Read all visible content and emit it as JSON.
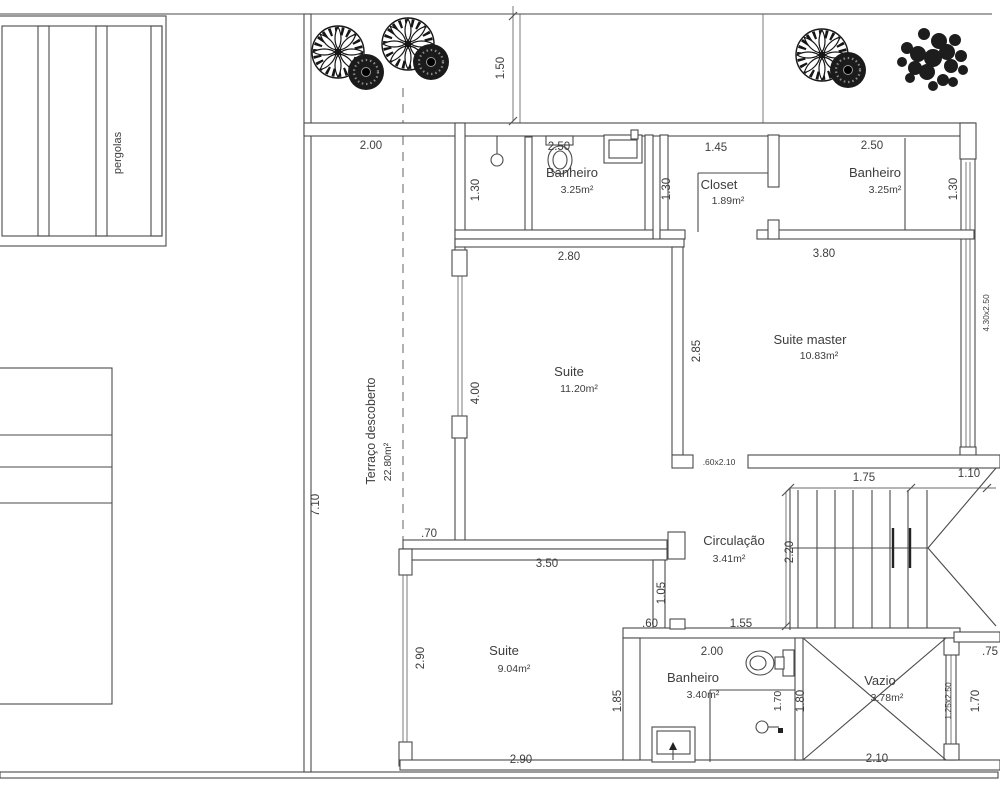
{
  "site": {
    "pergolas_label": "pergolas",
    "terrace": {
      "name": "Terraço descoberto",
      "area": "22.80m²"
    }
  },
  "rooms": {
    "banheiro_suite1": {
      "name": "Banheiro",
      "area": "3.25m²"
    },
    "closet": {
      "name": "Closet",
      "area": "1.89m²"
    },
    "banheiro_master": {
      "name": "Banheiro",
      "area": "3.25m²"
    },
    "suite1": {
      "name": "Suite",
      "area": "11.20m²"
    },
    "suite_master": {
      "name": "Suite master",
      "area": "10.83m²"
    },
    "circulacao": {
      "name": "Circulação",
      "area": "3.41m²"
    },
    "suite2": {
      "name": "Suite",
      "area": "9.04m²"
    },
    "banheiro_suite2": {
      "name": "Banheiro",
      "area": "3.40m²"
    },
    "vazio": {
      "name": "Vazio",
      "area": "3.78m²"
    }
  },
  "dimensions": {
    "terrace_door_width": "2.00",
    "front_setback": "1.50",
    "banheiro1_width": "2.50",
    "banheiro1_depth": "1.30",
    "closet_width": "1.45",
    "closet_depth": "1.30",
    "banheiro_master_width": "2.50",
    "banheiro_master_depth": "1.30",
    "suite1_width": "2.80",
    "suite1_window": "4.00",
    "suite_master_width": "3.80",
    "suite_master_depth": "2.85",
    "suite_master_window": "4.30x2.50",
    "suite_master_door": ".60x2.10",
    "terrace_length": "7.10",
    "terrace_wall": ".70",
    "stair_run": "1.75",
    "stair_landing": "1.10",
    "stair_width": "2.20",
    "suite2_top": "3.50",
    "suite2_door": "1.05",
    "suite2_side": "2.90",
    "suite2_bottom": "2.90",
    "suite2_right": "1.85",
    "banheiro2_offset": ".60",
    "banheiro2_top": "1.55",
    "banheiro2_width": "2.00",
    "banheiro2_shower": "1.70",
    "vazio_height": "1.80",
    "vazio_width": "2.10",
    "vazio_window": "1.25x2.50",
    "right_room_side": "1.70",
    "right_room_top": ".75"
  }
}
